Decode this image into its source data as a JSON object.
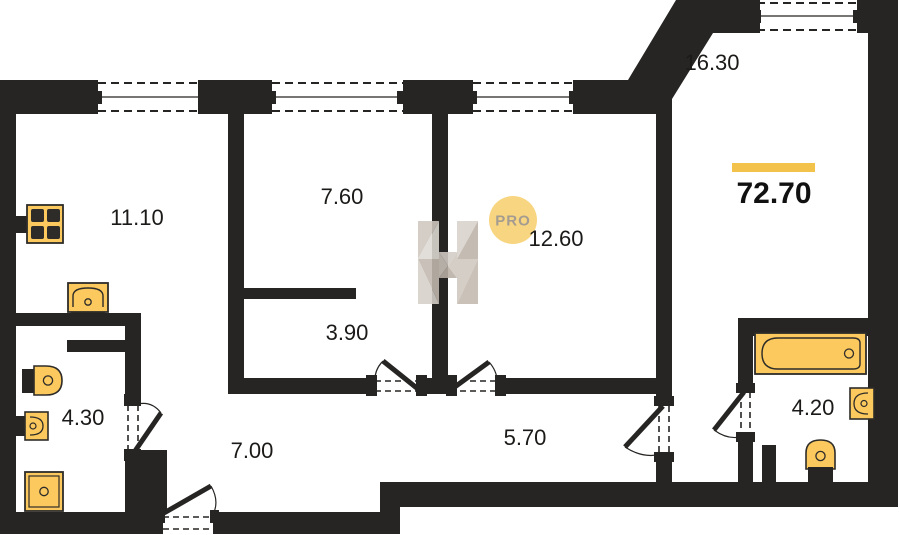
{
  "plan": {
    "total_area": "72.70",
    "watermark": {
      "logo_letter": "H",
      "badge_text": "PRO"
    },
    "rooms": [
      {
        "id": "room-11-10",
        "area": "11.10"
      },
      {
        "id": "room-7-60",
        "area": "7.60"
      },
      {
        "id": "room-12-60",
        "area": "12.60"
      },
      {
        "id": "room-16-30",
        "area": "16.30"
      },
      {
        "id": "room-3-90",
        "area": "3.90"
      },
      {
        "id": "room-4-30",
        "area": "4.30"
      },
      {
        "id": "room-7-00",
        "area": "7.00"
      },
      {
        "id": "room-5-70",
        "area": "5.70"
      },
      {
        "id": "room-4-20",
        "area": "4.20"
      }
    ],
    "fixtures": [
      "stove",
      "kitchen-sink",
      "toilet",
      "washbasin",
      "shower-tray",
      "bathtub",
      "washbasin",
      "toilet"
    ],
    "colors": {
      "wall": "#262523",
      "background": "#ffffff",
      "fixture_fill": "#fbc95d",
      "fixture_stroke": "#2e2c29",
      "accent_bar": "#f3c24b",
      "badge_fill": "#f8d580",
      "badge_text": "#a49c91",
      "label_text": "#1b1a18",
      "watermark_gray_light": "#ded9d3",
      "watermark_gray_dark": "#b9afa4"
    }
  }
}
